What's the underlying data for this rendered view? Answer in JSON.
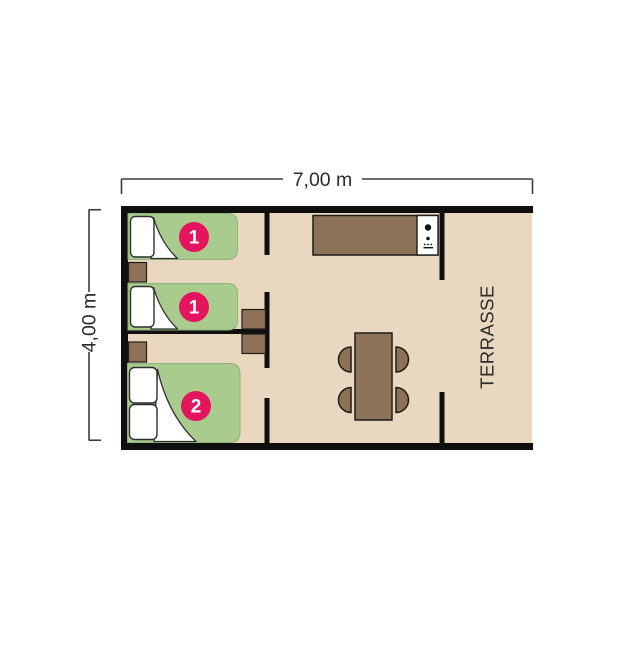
{
  "colors": {
    "wall": "#0f0f0f",
    "floor": "#e9d8bf",
    "bed": "#a9cc8e",
    "bedEdge": "#8fb374",
    "badge": "#e4155c",
    "wood": "#8d7257",
    "outline": "#1c1c1c",
    "dim": "#3c3c3c",
    "text": "#2b2b2b",
    "white": "#ffffff"
  },
  "dimensions": {
    "width": "7,00 m",
    "height": "4,00 m"
  },
  "labels": {
    "terrace": "TERRASSE"
  },
  "beds": [
    {
      "name": "single-bed-1",
      "badge": "1"
    },
    {
      "name": "single-bed-2",
      "badge": "1"
    },
    {
      "name": "double-bed",
      "badge": "2"
    }
  ]
}
